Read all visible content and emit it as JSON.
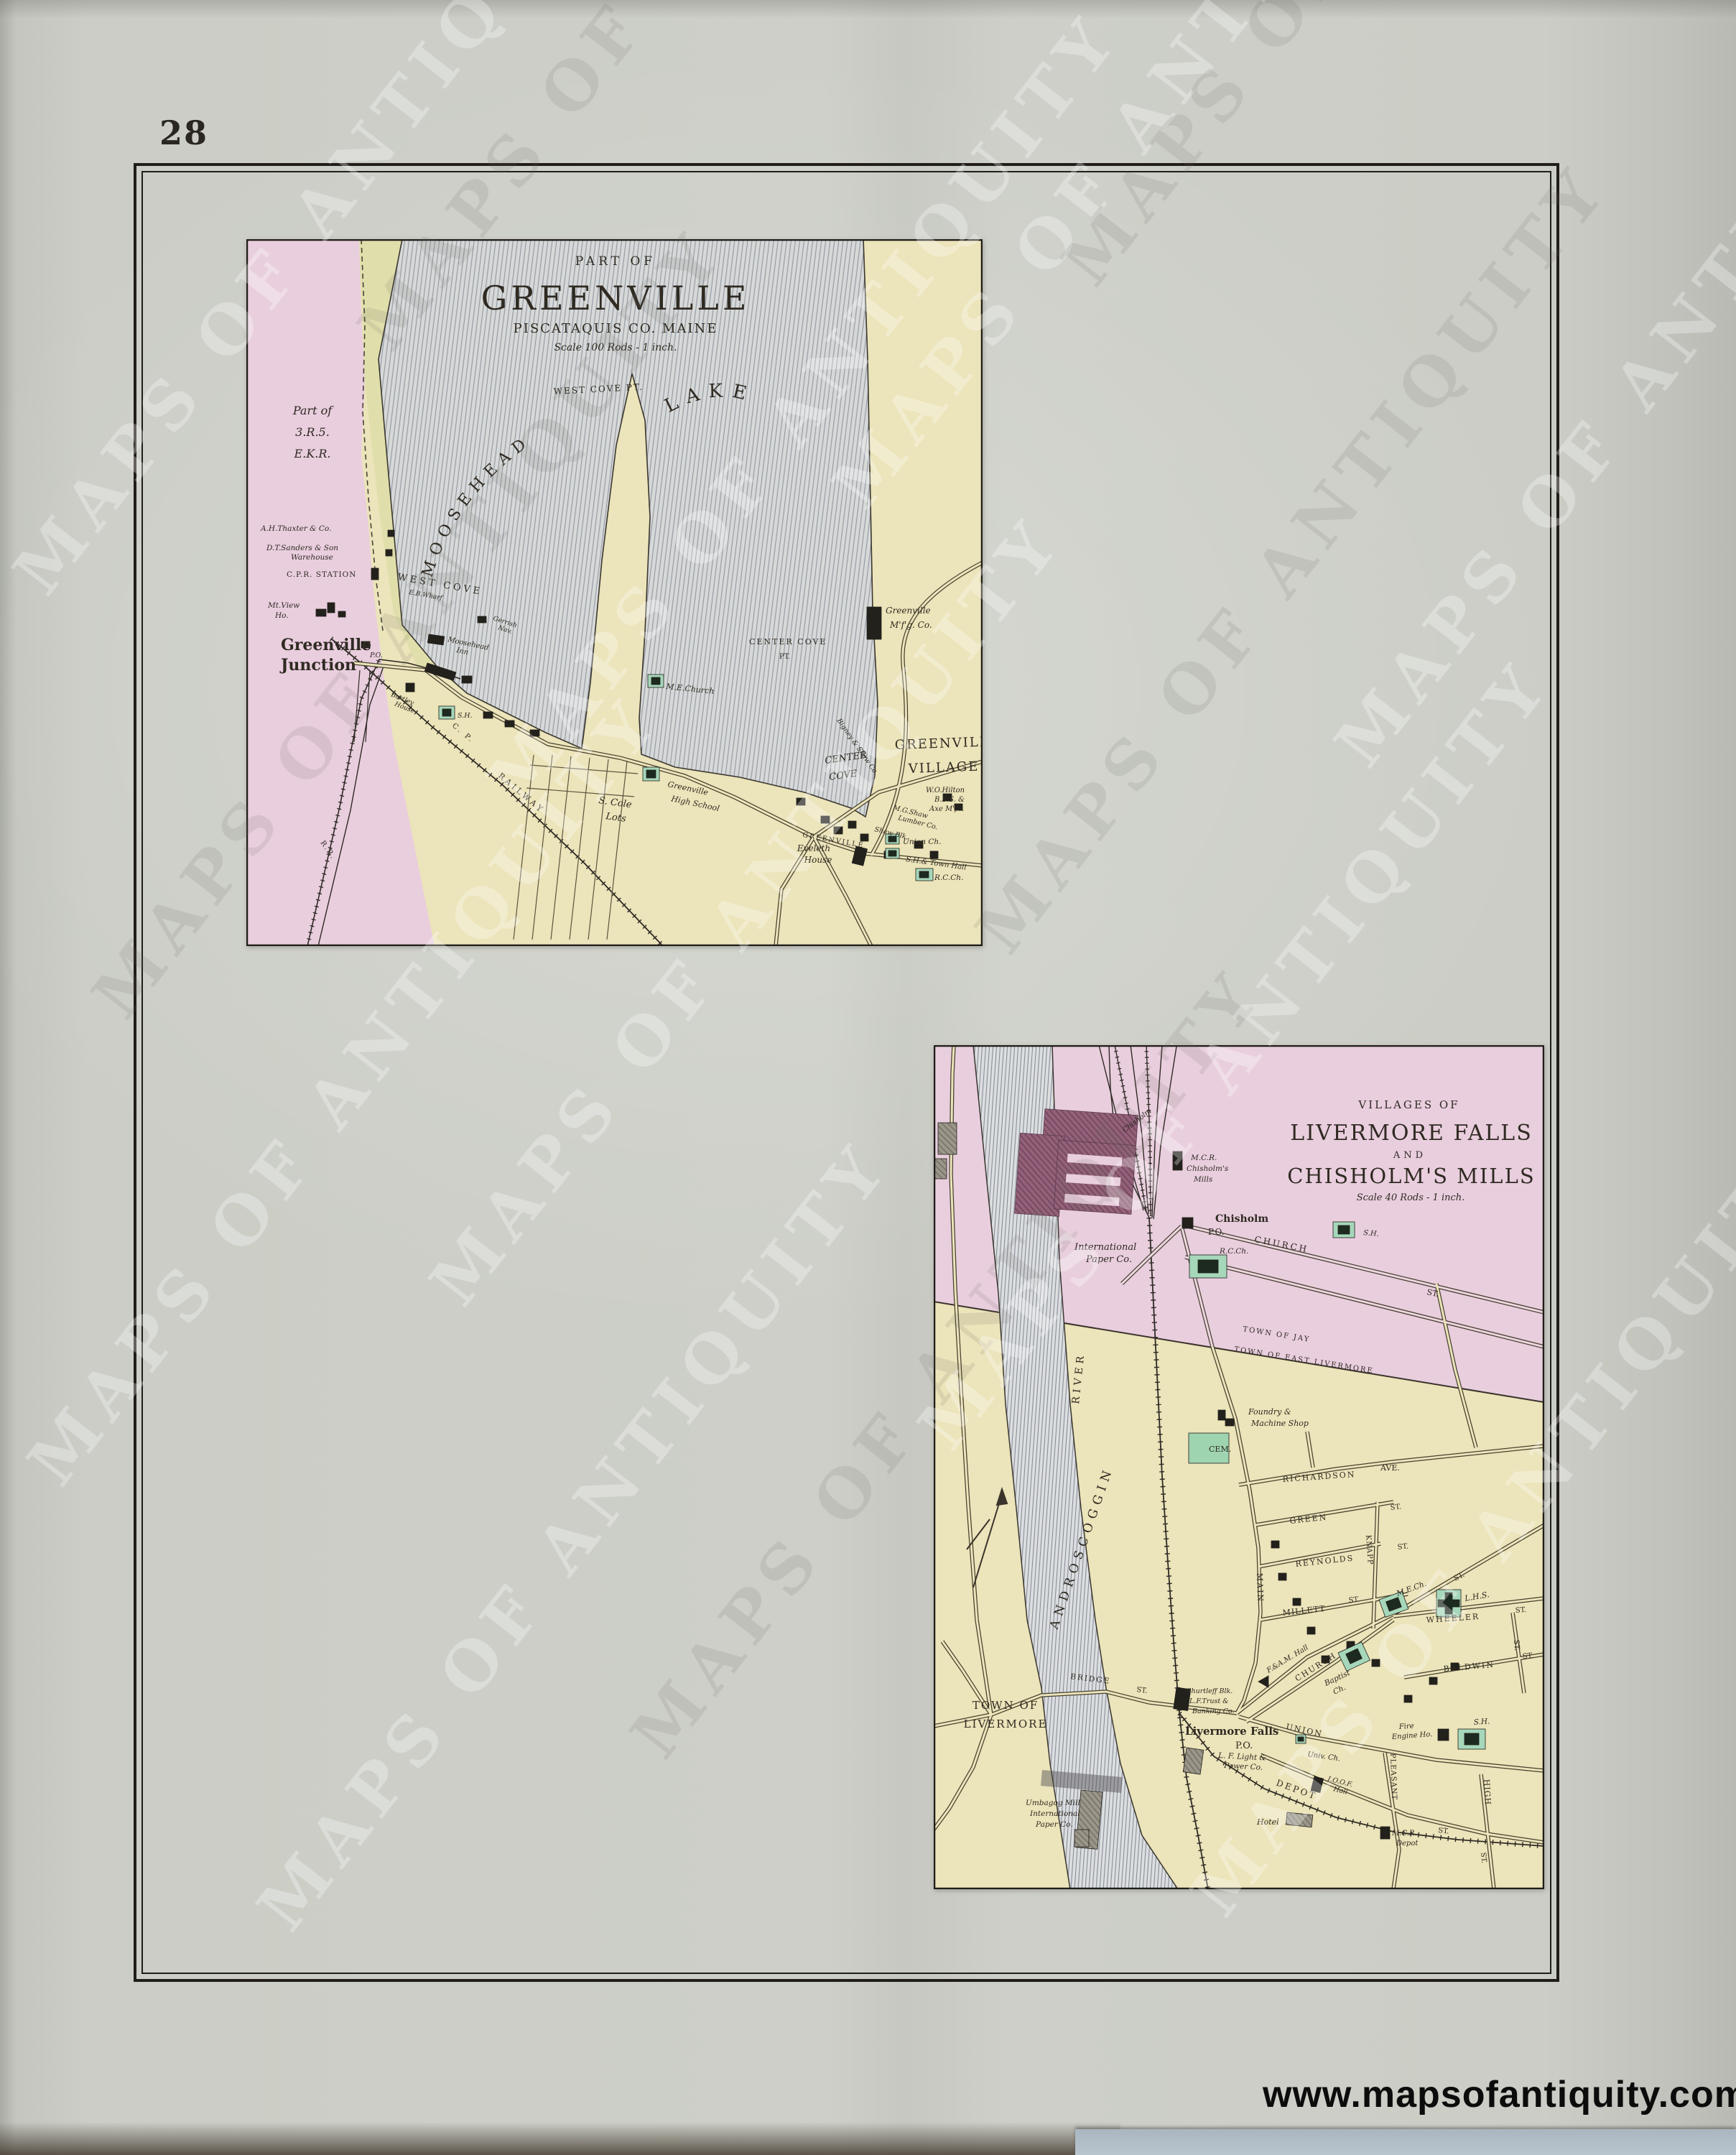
{
  "page": {
    "number": "28",
    "url": "www.mapsofantiquity.com",
    "watermark": "MAPS OF ANTIQUITY"
  },
  "colors": {
    "paper": "#c9cbc4",
    "map_cream": "#ece4ba",
    "township_pink": "#e9cede",
    "water_line": "#8f95a0",
    "building_green": "#a6d7ba",
    "mill_maroon": "#8e5a72",
    "ink": "#2f2a22"
  },
  "greenville": {
    "part_of": "PART OF",
    "name": "GREENVILLE",
    "county": "PISCATAQUIS CO. MAINE",
    "scale": "Scale 100 Rods - 1 inch.",
    "labels": [
      "Part of",
      "3.R.5.",
      "E.K.R.",
      "A.H.Thaxter & Co.",
      "D.T.Sanders & Son",
      "Warehouse",
      "C.P.R. STATION",
      "Mt.View",
      "Ho.",
      "Greenville",
      "Junction",
      "P.O.",
      "WEST COVE",
      "E.B.Wharf",
      "MOOSEHEAD",
      "LAKE",
      "WEST COVE PT.",
      "CENTER COVE",
      "PT.",
      "CENTER",
      "COVE",
      "Greenville",
      "M'f'g. Co.",
      "GREENVILLE",
      "VILLAGE",
      "Gerrish",
      "Nav.",
      "Moosehead",
      "Inn",
      "Bartley",
      "House",
      "S.H.",
      "M.E.Church",
      "C. P.",
      "RAILWAY",
      "S. Cole",
      "Lots",
      "Greenville",
      "High School",
      "GREENVILLE",
      "Eveleth",
      "House",
      "Union Ch.",
      "S.H.& Town Hall",
      "R.C.Ch.",
      "M.G.Shaw",
      "Lumber Co.",
      "Shaw Blk.",
      "W.O.Hilton",
      "B.S.S. &",
      "Axe M'f'r.",
      "R.R.",
      "Bigney & Shaw Co."
    ]
  },
  "livermore": {
    "villages_of": "VILLAGES OF",
    "name1": "LIVERMORE FALLS",
    "and_word": "AND",
    "name2": "CHISHOLM'S MILLS",
    "scale": "Scale 40 Rods - 1 inch.",
    "labels": [
      "VILLAGES OF",
      "LIVERMORE FALLS",
      "AND",
      "CHISHOLM'S MILLS",
      "Scale 40 Rods - 1 inch.",
      "M.C.R.",
      "Chisholm's",
      "Mills",
      "Chisholm",
      "P.O.",
      "CHURCH",
      "ST.",
      "S.H.",
      "R.C.Ch.",
      "International",
      "Paper Co.",
      "Chisholm",
      "TOWN OF JAY",
      "TOWN OF EAST LIVERMORE",
      "Foundry &",
      "Machine Shop",
      "CEM.",
      "RICHARDSON",
      "AVE.",
      "GREEN",
      "ST.",
      "REYNOLDS",
      "ST.",
      "MAIN",
      "MILLETT",
      "ST.",
      "KNAPP",
      "ST.",
      "M.E.Ch.",
      "L.H.S.",
      "WHEELER",
      "ST.",
      "BALDWIN",
      "ST.",
      "F.&A.M. Hall",
      "CHURCH",
      "Baptist",
      "Ch.",
      "UNION",
      "Univ. Ch.",
      "Shurtleff Blk.",
      "L.F.Trust &",
      "Banking Co.",
      "Livermore Falls",
      "P.O.",
      "L. F. Light &",
      "Power Co.",
      "Fire",
      "Engine Ho.",
      "S.H.",
      "PLEASANT",
      "DEPOT",
      "ST.",
      "I.O.O.F.",
      "Hall",
      "Hotel",
      "M.C.R.",
      "Depot",
      "HIGH",
      "ST.",
      "TOWN OF",
      "LIVERMORE",
      "ANDROSCOGGIN",
      "RIVER",
      "BRIDGE",
      "ST.",
      "Umbagog Mill",
      "International",
      "Paper Co.",
      "ST."
    ]
  }
}
